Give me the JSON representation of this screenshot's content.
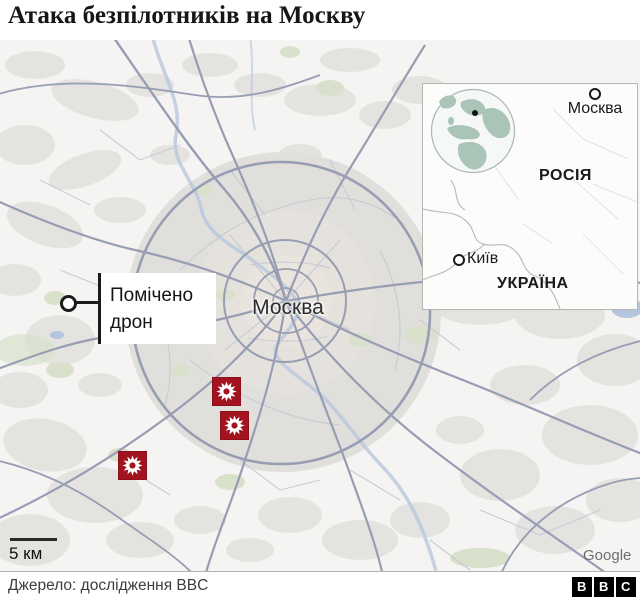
{
  "title": "Атака безпілотників на Москву",
  "map": {
    "city_label": "Москва",
    "callout_line1": "Помічено",
    "callout_line2": "дрон",
    "scale_label": "5 км",
    "attribution": "Google",
    "explosion_site_count": 3
  },
  "inset": {
    "moscow_label": "Москва",
    "russia_label": "РОСІЯ",
    "kyiv_label": "Київ",
    "ukraine_label": "УКРАЇНА"
  },
  "footer": {
    "source": "Джерело: дослідження BBC",
    "bbc": [
      "B",
      "B",
      "C"
    ]
  },
  "colors": {
    "marker_red": "#a3131f",
    "marker_edge": "#8c0f19",
    "road_major": "#979db2",
    "road_minor": "#c6c9d5",
    "water": "#b4c5dd",
    "land_patch": "#e3e2df",
    "urban_gray": "#e0dfdc",
    "green_patch": "#d9e1cc",
    "globe_land": "#abc4b8"
  }
}
